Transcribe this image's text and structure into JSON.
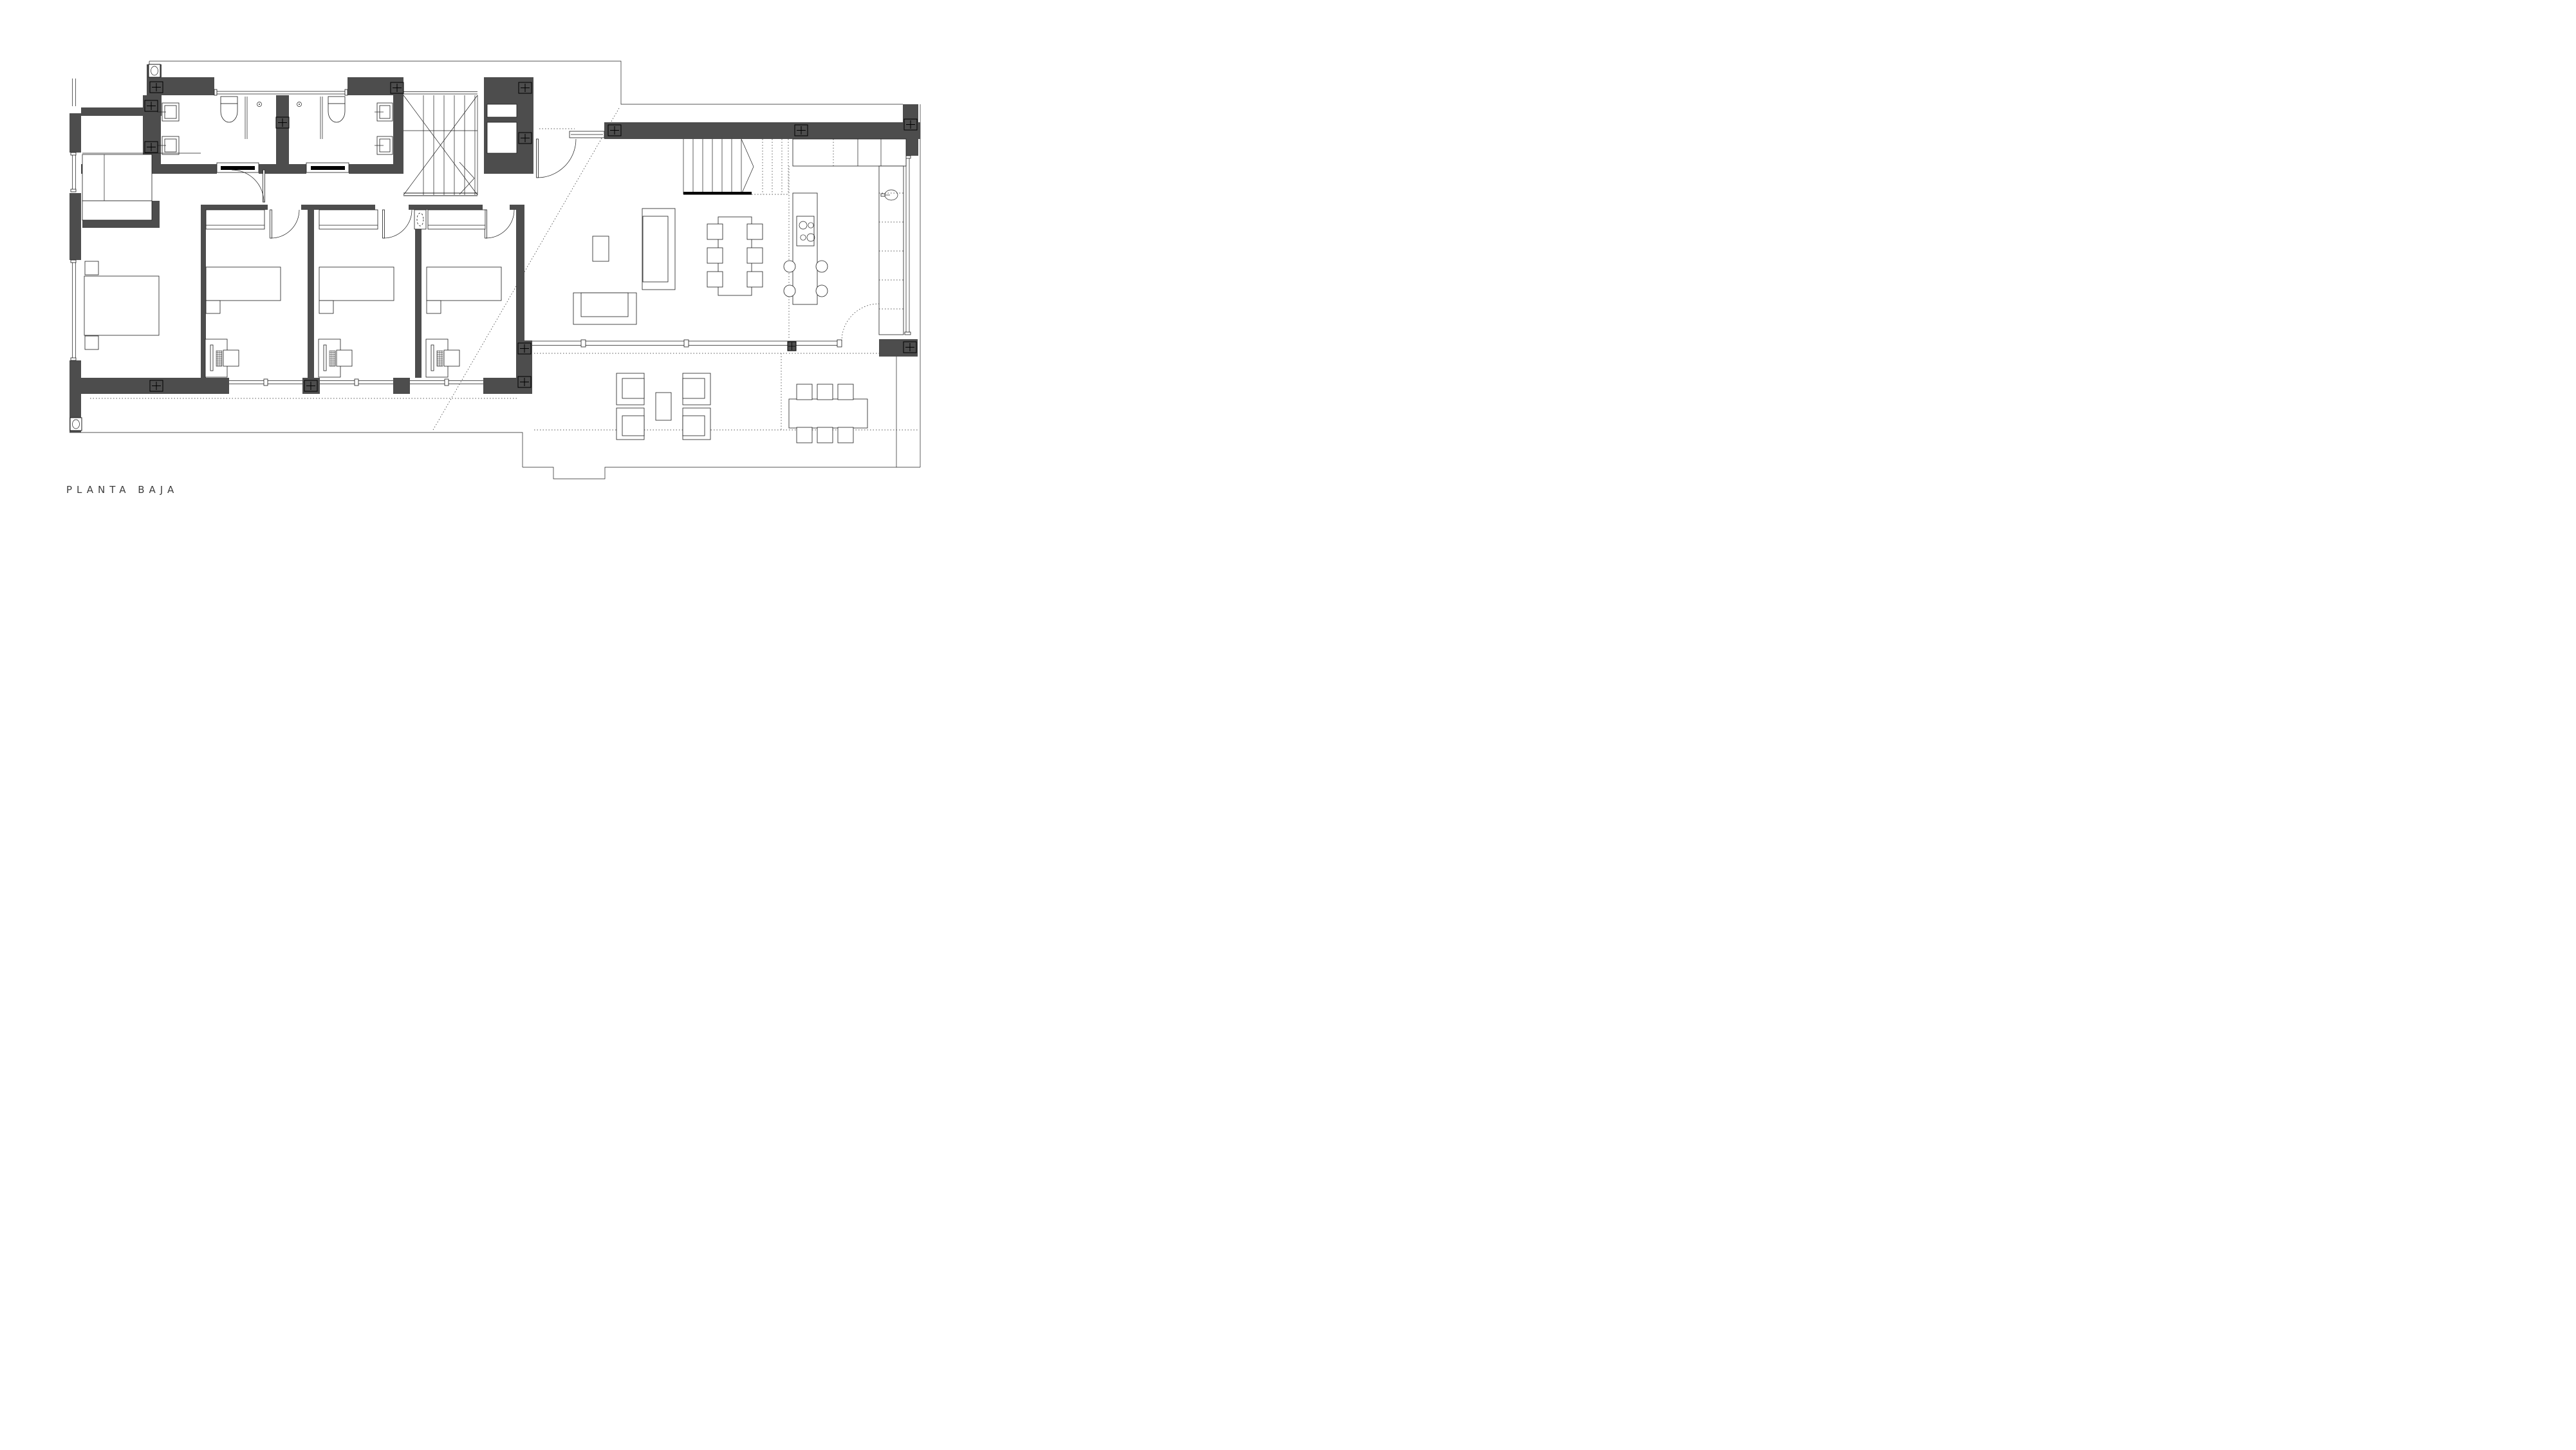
{
  "title": {
    "label": "PLANTA BAJA"
  },
  "palette": {
    "bg": "#ffffff",
    "wall": "#4d4d4d",
    "ink": "#1c1c1c"
  },
  "drawing": {
    "type": "architectural-floor-plan",
    "floor_label": "PLANTA BAJA",
    "depicted_rooms": [
      "laundry-storage",
      "bathroom-1",
      "bathroom-2",
      "central-staircase",
      "entry-hall",
      "dressing-area",
      "master-bedroom",
      "corridor",
      "bedroom-1",
      "bedroom-2",
      "bedroom-3",
      "living-room",
      "dining-area",
      "kitchen",
      "lower-staircase",
      "terrace"
    ],
    "depicted_counts": {
      "beds": 4,
      "nightstands": 5,
      "desks": 3,
      "desk_chairs": 3,
      "wardrobes": 4,
      "toilets": 2,
      "washbasins": 4,
      "showers": 2,
      "sofas": 2,
      "coffee_tables": 2,
      "dining_chairs": 6,
      "kitchen_island_stools": 4,
      "hob_burners": 4,
      "kitchen_sink": 1,
      "outdoor_armchairs": 4,
      "outdoor_dining_chairs": 6,
      "column_markers": 15,
      "light_markers": 2,
      "staircases": 2
    }
  }
}
